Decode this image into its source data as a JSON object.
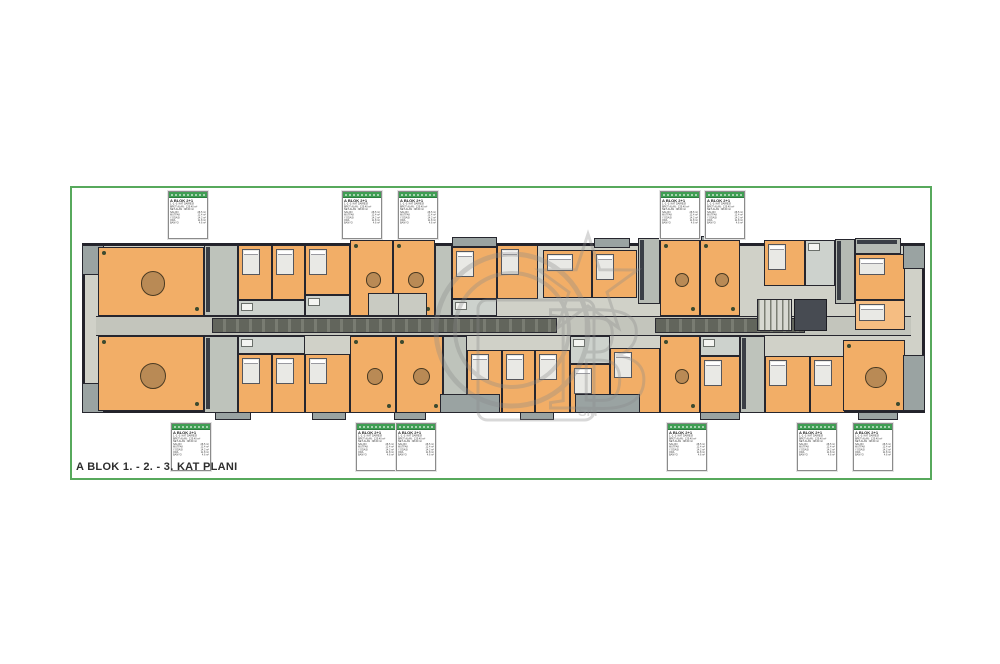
{
  "title": "A BLOK 1. - 2. - 3. KAT PLANI",
  "watermark": {
    "letter_b": "B",
    "sm": "SM"
  },
  "card": {
    "title": "A BLOK 2+1",
    "lines": [
      "1.-2.-3. KAT DAİRESİ",
      "BRÜT ALAN : 125.40 m²",
      "NET ALAN : 98.60 m²"
    ],
    "rows": [
      [
        "SALON",
        "28.5 m²"
      ],
      [
        "MUTFAK",
        "12.4 m²"
      ],
      [
        "Y.ODASI",
        "14.2 m²"
      ],
      [
        "ODA",
        "11.8 m²"
      ],
      [
        "BANYO",
        "4.6 m²"
      ]
    ]
  },
  "cards": {
    "top": [
      [
        168,
        191
      ],
      [
        342,
        191
      ],
      [
        398,
        191
      ],
      [
        660,
        191
      ],
      [
        705,
        191
      ]
    ],
    "bottom": [
      [
        171,
        423
      ],
      [
        356,
        423
      ],
      [
        396,
        423
      ],
      [
        667,
        423
      ],
      [
        797,
        423
      ],
      [
        853,
        423
      ]
    ]
  },
  "plan": {
    "rooms": [
      [
        "base",
        82,
        243,
        843,
        170
      ],
      [
        "cor",
        96,
        316,
        815,
        20
      ],
      [
        "corD",
        212,
        318,
        345,
        15
      ],
      [
        "corD",
        655,
        318,
        150,
        15
      ],
      [
        "bal",
        82,
        245,
        22,
        30
      ],
      [
        "liv",
        98,
        247,
        106,
        69
      ],
      [
        "util",
        204,
        245,
        34,
        71
      ],
      [
        "bed",
        238,
        245,
        34,
        55
      ],
      [
        "bed",
        272,
        245,
        33,
        55
      ],
      [
        "bath",
        238,
        300,
        67,
        16
      ],
      [
        "bed",
        305,
        245,
        45,
        50
      ],
      [
        "bath",
        305,
        295,
        45,
        21
      ],
      [
        "liv",
        350,
        240,
        43,
        76
      ],
      [
        "liv",
        393,
        240,
        42,
        76
      ],
      [
        "elev",
        368,
        293,
        59,
        23
      ],
      [
        "hall",
        435,
        245,
        17,
        71
      ],
      [
        "balT",
        452,
        237,
        45,
        10
      ],
      [
        "bed",
        452,
        247,
        45,
        52
      ],
      [
        "bath",
        452,
        299,
        45,
        17
      ],
      [
        "bed",
        497,
        245,
        41,
        54
      ],
      [
        "bed",
        543,
        250,
        49,
        48
      ],
      [
        "bed",
        592,
        250,
        45,
        48
      ],
      [
        "balT",
        594,
        238,
        36,
        10
      ],
      [
        "kit",
        638,
        238,
        22,
        66
      ],
      [
        "liv",
        660,
        240,
        40,
        76
      ],
      [
        "balT",
        701,
        236,
        36,
        9
      ],
      [
        "liv",
        700,
        240,
        40,
        76
      ],
      [
        "bed",
        764,
        240,
        41,
        46
      ],
      [
        "bath",
        805,
        240,
        30,
        46
      ],
      [
        "stair",
        757,
        299,
        35,
        32
      ],
      [
        "shaft",
        794,
        299,
        33,
        32
      ],
      [
        "kit",
        835,
        239,
        20,
        65
      ],
      [
        "cnt",
        855,
        238,
        46,
        16
      ],
      [
        "bed",
        855,
        254,
        50,
        46
      ],
      [
        "bal",
        903,
        245,
        22,
        24
      ],
      [
        "bed2",
        855,
        300,
        50,
        30
      ],
      [
        "bal",
        82,
        383,
        22,
        30
      ],
      [
        "liv",
        98,
        336,
        106,
        75
      ],
      [
        "util",
        204,
        336,
        34,
        77
      ],
      [
        "bath",
        238,
        336,
        67,
        18
      ],
      [
        "bed",
        238,
        354,
        34,
        59
      ],
      [
        "bed",
        272,
        354,
        33,
        59
      ],
      [
        "bed",
        305,
        354,
        45,
        59
      ],
      [
        "liv",
        350,
        336,
        46,
        77
      ],
      [
        "liv",
        396,
        336,
        47,
        77
      ],
      [
        "hall",
        443,
        336,
        24,
        77
      ],
      [
        "bed",
        467,
        350,
        35,
        63
      ],
      [
        "bed",
        502,
        350,
        33,
        63
      ],
      [
        "bed",
        535,
        350,
        35,
        63
      ],
      [
        "bal",
        440,
        394,
        60,
        19
      ],
      [
        "bath",
        570,
        336,
        40,
        28
      ],
      [
        "bed",
        570,
        364,
        40,
        49
      ],
      [
        "bed",
        610,
        348,
        50,
        65
      ],
      [
        "bal",
        575,
        394,
        65,
        19
      ],
      [
        "liv",
        660,
        336,
        40,
        77
      ],
      [
        "bath",
        700,
        336,
        40,
        20
      ],
      [
        "bed",
        700,
        356,
        40,
        57
      ],
      [
        "util",
        740,
        336,
        25,
        77
      ],
      [
        "bed",
        765,
        356,
        45,
        57
      ],
      [
        "bed",
        810,
        356,
        35,
        57
      ],
      [
        "liv",
        843,
        340,
        62,
        71
      ],
      [
        "bal",
        903,
        355,
        22,
        56
      ],
      [
        "balB",
        215,
        412,
        36,
        8
      ],
      [
        "balB",
        312,
        412,
        34,
        8
      ],
      [
        "balB",
        394,
        412,
        32,
        8
      ],
      [
        "balB",
        520,
        412,
        34,
        8
      ],
      [
        "balB",
        700,
        412,
        40,
        8
      ],
      [
        "balB",
        858,
        412,
        40,
        8
      ]
    ]
  }
}
